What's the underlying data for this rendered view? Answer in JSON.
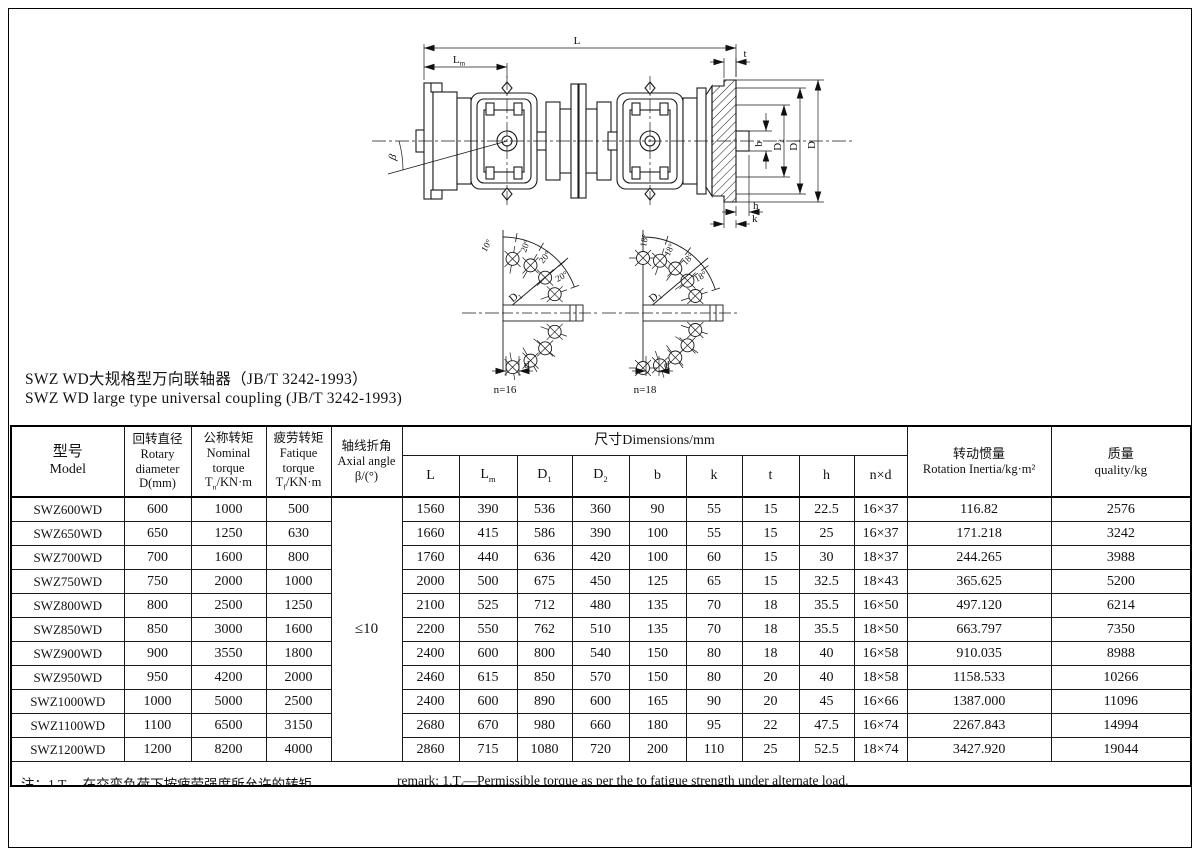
{
  "page": {
    "title_zh": "SWZ WD大规格型万向联轴器（JB/T 3242-1993）",
    "title_en": "SWZ WD large type universal coupling (JB/T 3242-1993)"
  },
  "drawing": {
    "labels": {
      "L": "L",
      "Lm": {
        "main": "L",
        "sub": "m"
      },
      "t": "t",
      "beta": "β",
      "b": "b",
      "D2": {
        "main": "D",
        "sub": "2"
      },
      "D1": {
        "main": "D",
        "sub": "1"
      },
      "D": "D",
      "h": "h",
      "k": "k"
    },
    "viewA": {
      "angles": [
        "10°",
        "20°",
        "20°",
        "20°"
      ],
      "bolt_circle": {
        "main": "D",
        "sub": "1"
      },
      "hole_dia": "d",
      "count": "n=16"
    },
    "viewB": {
      "angles": [
        "18°",
        "18°",
        "18°",
        "18°"
      ],
      "bolt_circle": {
        "main": "D",
        "sub": "1"
      },
      "hole_dia": "d",
      "count": "n=18"
    }
  },
  "table": {
    "header": {
      "model": [
        "型号",
        "Model"
      ],
      "rotary": [
        "回转直径",
        "Rotary",
        "diameter",
        "D(mm)"
      ],
      "nominal": [
        "公称转矩",
        "Nominal",
        "torque",
        "T~n~/KN·m"
      ],
      "fatigue": [
        "疲劳转矩",
        "Fatique",
        "torque",
        "T~f~/KN·m"
      ],
      "axial": [
        "轴线折角",
        "Axial angle",
        "β/(°)"
      ],
      "dims_band": "尺寸Dimensions/mm",
      "dims": [
        "L",
        "L~m~",
        "D~1~",
        "D~2~",
        "b",
        "k",
        "t",
        "h",
        "n×d"
      ],
      "inertia": [
        "转动惯量",
        "Rotation Inertia/kg·m²"
      ],
      "quality": [
        "质量",
        "quality/kg"
      ]
    },
    "axial_value": "≤10",
    "rows": [
      [
        "SWZ600WD",
        "600",
        "1000",
        "500",
        "1560",
        "390",
        "536",
        "360",
        "90",
        "55",
        "15",
        "22.5",
        "16×37",
        "116.82",
        "2576"
      ],
      [
        "SWZ650WD",
        "650",
        "1250",
        "630",
        "1660",
        "415",
        "586",
        "390",
        "100",
        "55",
        "15",
        "25",
        "16×37",
        "171.218",
        "3242"
      ],
      [
        "SWZ700WD",
        "700",
        "1600",
        "800",
        "1760",
        "440",
        "636",
        "420",
        "100",
        "60",
        "15",
        "30",
        "18×37",
        "244.265",
        "3988"
      ],
      [
        "SWZ750WD",
        "750",
        "2000",
        "1000",
        "2000",
        "500",
        "675",
        "450",
        "125",
        "65",
        "15",
        "32.5",
        "18×43",
        "365.625",
        "5200"
      ],
      [
        "SWZ800WD",
        "800",
        "2500",
        "1250",
        "2100",
        "525",
        "712",
        "480",
        "135",
        "70",
        "18",
        "35.5",
        "16×50",
        "497.120",
        "6214"
      ],
      [
        "SWZ850WD",
        "850",
        "3000",
        "1600",
        "2200",
        "550",
        "762",
        "510",
        "135",
        "70",
        "18",
        "35.5",
        "18×50",
        "663.797",
        "7350"
      ],
      [
        "SWZ900WD",
        "900",
        "3550",
        "1800",
        "2400",
        "600",
        "800",
        "540",
        "150",
        "80",
        "18",
        "40",
        "16×58",
        "910.035",
        "8988"
      ],
      [
        "SWZ950WD",
        "950",
        "4200",
        "2000",
        "2460",
        "615",
        "850",
        "570",
        "150",
        "80",
        "20",
        "40",
        "18×58",
        "1158.533",
        "10266"
      ],
      [
        "SWZ1000WD",
        "1000",
        "5000",
        "2500",
        "2400",
        "600",
        "890",
        "600",
        "165",
        "90",
        "20",
        "45",
        "16×66",
        "1387.000",
        "11096"
      ],
      [
        "SWZ1100WD",
        "1100",
        "6500",
        "3150",
        "2680",
        "670",
        "980",
        "660",
        "180",
        "95",
        "22",
        "47.5",
        "16×74",
        "2267.843",
        "14994"
      ],
      [
        "SWZ1200WD",
        "1200",
        "8200",
        "4000",
        "2860",
        "715",
        "1080",
        "720",
        "200",
        "110",
        "25",
        "52.5",
        "18×74",
        "3427.920",
        "19044"
      ]
    ]
  },
  "footnote": {
    "zh": "注：1.T~f~—在交变负荷下按疲劳强度所允许的转矩。",
    "en": "remark: 1.T~f~—Permissible torque as per the to fatigue strength under alternate load."
  }
}
